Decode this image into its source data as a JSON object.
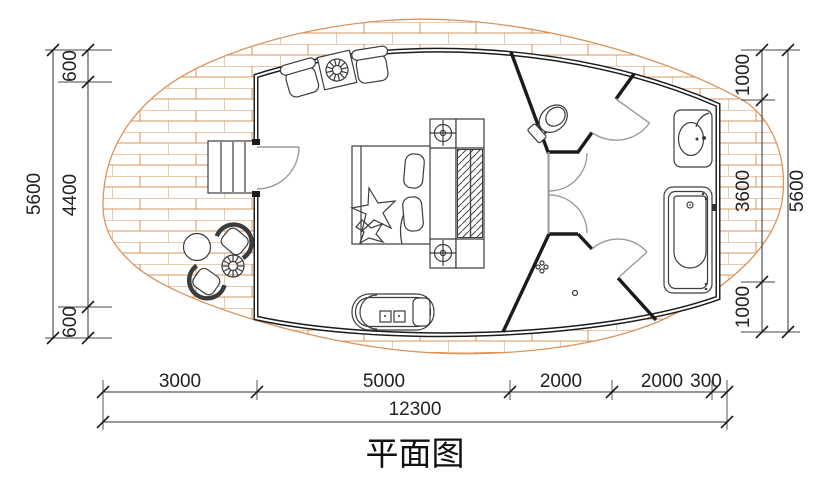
{
  "title": "平面图",
  "dimensions": {
    "left": {
      "total": "5600",
      "chain": [
        "600",
        "4400",
        "600"
      ]
    },
    "right": {
      "total": "5600",
      "chain": [
        "1000",
        "3600",
        "1000"
      ]
    },
    "bottom": {
      "total": "12300",
      "chain": [
        "3000",
        "5000",
        "2000",
        "2000",
        "300"
      ]
    }
  },
  "colors": {
    "wood": "#d9945c",
    "wall": "#1b1b1b",
    "door": "#9b9b9b",
    "ink": "#222222"
  },
  "furniture": [
    "entry-stairs",
    "entry-door",
    "lounge-chairs",
    "rattan-table",
    "double-bed",
    "bedside-lamps",
    "wardrobe",
    "chaise-lounge",
    "outdoor-armchairs",
    "outdoor-round-table",
    "rattan-stool",
    "toilet",
    "double-swing-doors",
    "shower-drain",
    "washbasin",
    "bathtub"
  ]
}
